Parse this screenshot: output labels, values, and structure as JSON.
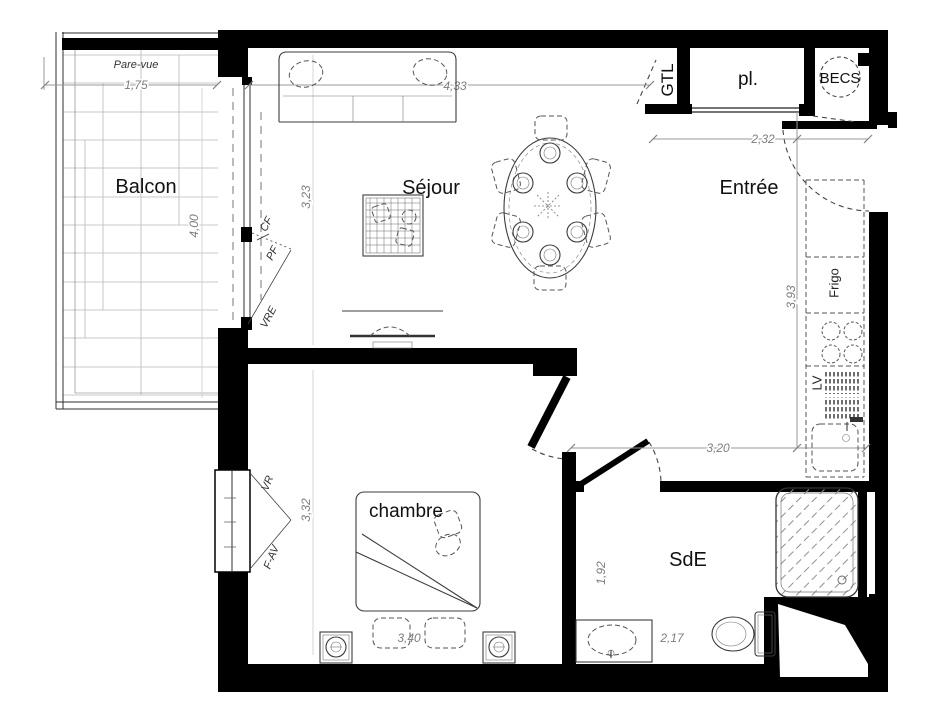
{
  "plan": {
    "rooms": {
      "balcon": "Balcon",
      "sejour": "Séjour",
      "entree": "Entrée",
      "chambre": "chambre",
      "sde": "SdE",
      "placard": "pl.",
      "gtl": "GTL",
      "becs": "BECS"
    },
    "kitchen": {
      "frigo": "Frigo",
      "lv": "LV"
    },
    "window_labels": {
      "pare_vue": "Pare-vue",
      "pf": "PF",
      "cf": "CF",
      "vre": "VRE",
      "vr": "VR",
      "f_av": "F-AV"
    },
    "dimensions": {
      "balcony_width": "1,75",
      "balcony_depth": "4,00",
      "sejour_width": "4,33",
      "sejour_depth": "3,23",
      "entree_width": "2,32",
      "kitchen_length": "3,93",
      "kitchen_span": "3,20",
      "chambre_depth": "3,32",
      "chambre_width": "3,40",
      "sde_depth": "1,92",
      "sde_width": "2,17"
    },
    "colors": {
      "wall": "#000000",
      "dimension": "#8c8c8c",
      "furniture": "#3c3c3c"
    }
  }
}
